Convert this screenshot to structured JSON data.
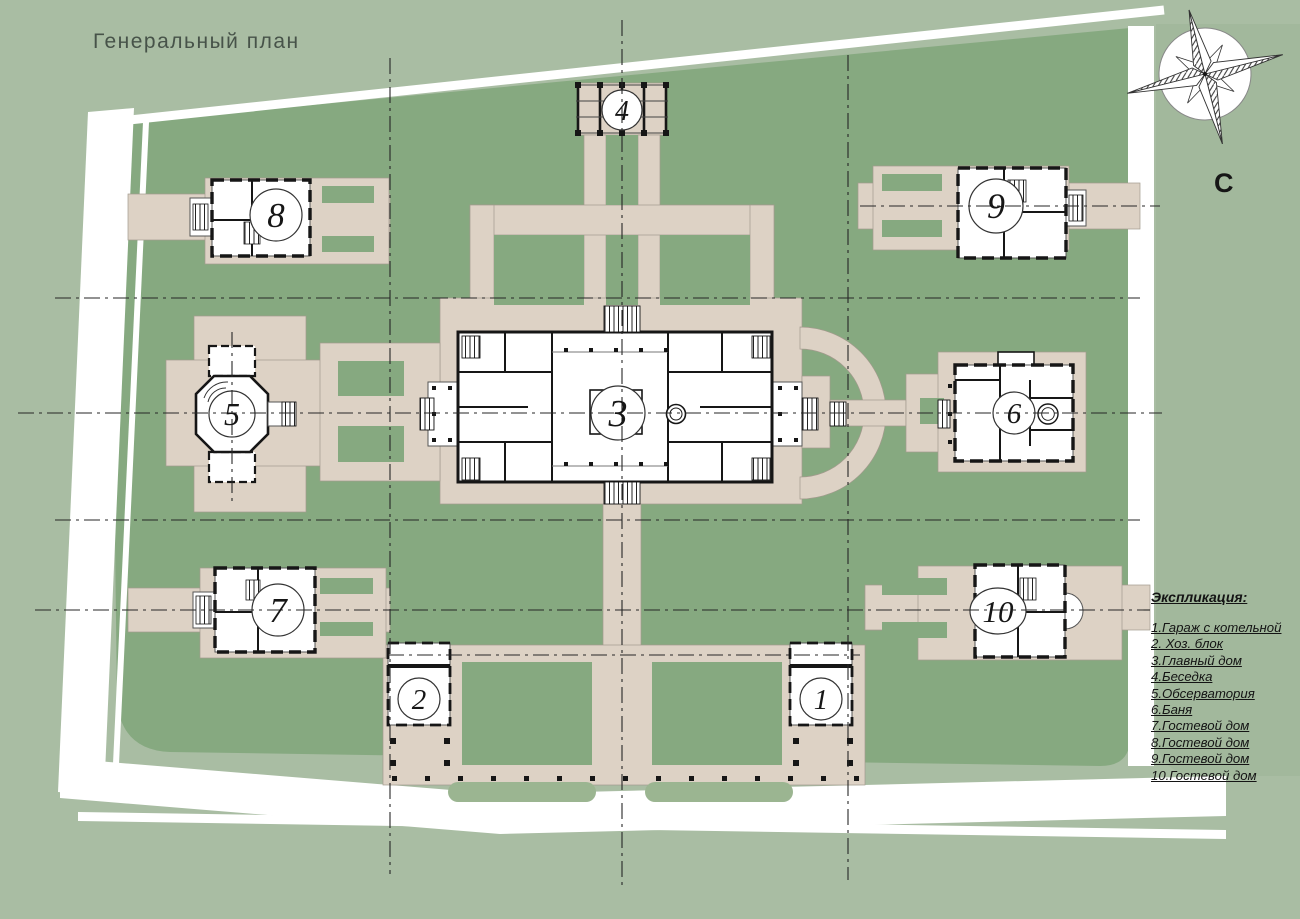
{
  "title": "Генеральный план",
  "compass": {
    "north_label": "С"
  },
  "legend": {
    "heading": "Экспликация:",
    "items": [
      "1.Гараж с котельной",
      "2. Хоз. блок",
      "3.Главный дом",
      "4.Беседка",
      "5.Обсерватория",
      "6.Баня",
      "7.Гостевой дом",
      "8.Гостевой дом",
      "9.Гостевой дом",
      "10.Гостевой дом"
    ]
  },
  "buildings": [
    {
      "number": "1"
    },
    {
      "number": "2"
    },
    {
      "number": "3"
    },
    {
      "number": "4"
    },
    {
      "number": "5"
    },
    {
      "number": "6"
    },
    {
      "number": "7"
    },
    {
      "number": "8"
    },
    {
      "number": "9"
    },
    {
      "number": "10"
    }
  ],
  "colors": {
    "background": "#a9bda3",
    "site_green": "#86a980",
    "path_beige": "#ddd2c5",
    "building_fill": "#ffffff",
    "wall": "#161616",
    "title_text": "#475349"
  }
}
